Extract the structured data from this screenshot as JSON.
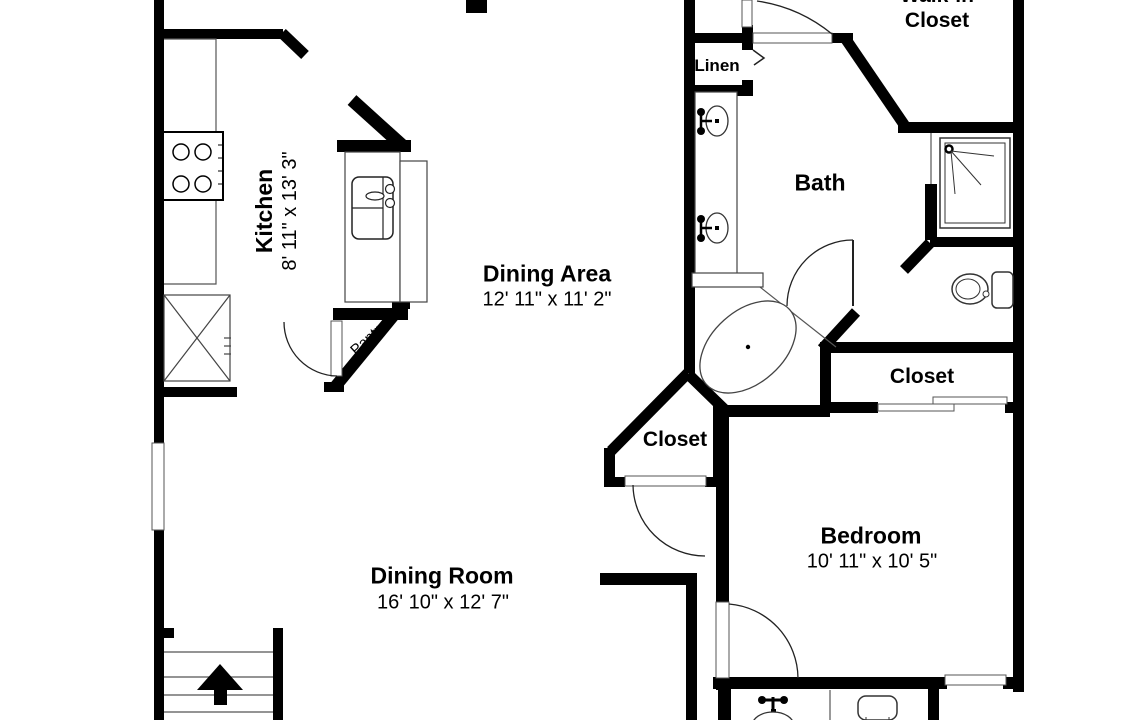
{
  "colors": {
    "wall": "#000000",
    "fixture_line": "#444444",
    "background": "#ffffff",
    "text": "#000000"
  },
  "rooms": {
    "kitchen": {
      "label": "Kitchen",
      "dims": "8' 11\" x 13' 3\""
    },
    "dining_area": {
      "label": "Dining Area",
      "dims": "12' 11\" x 11' 2\""
    },
    "dining_room": {
      "label": "Dining Room",
      "dims": "16' 10\" x 12' 7\""
    },
    "bedroom": {
      "label": "Bedroom",
      "dims": "10' 11\" x 10' 5\""
    },
    "bath": {
      "label": "Bath"
    },
    "linen": {
      "label": "Linen"
    },
    "walk_in_closet": {
      "line1": "Walk-in",
      "line2": "Closet"
    },
    "hall_closet": {
      "label": "Closet"
    },
    "bedroom_closet": {
      "label": "Closet"
    },
    "pantry": {
      "label": "Pantry"
    }
  },
  "fixtures": {
    "stove": "stove-icon",
    "refrigerator": "refrigerator-icon",
    "kitchen_sink": "kitchen-sink-icon",
    "double_vanity": "double-vanity-sink-icon",
    "bathtub": "bathtub-icon",
    "shower": "shower-icon",
    "toilet_main": "toilet-icon",
    "toilet_lower": "toilet-icon",
    "lower_sink": "sink-icon",
    "stairs": "stairs-up-icon"
  }
}
